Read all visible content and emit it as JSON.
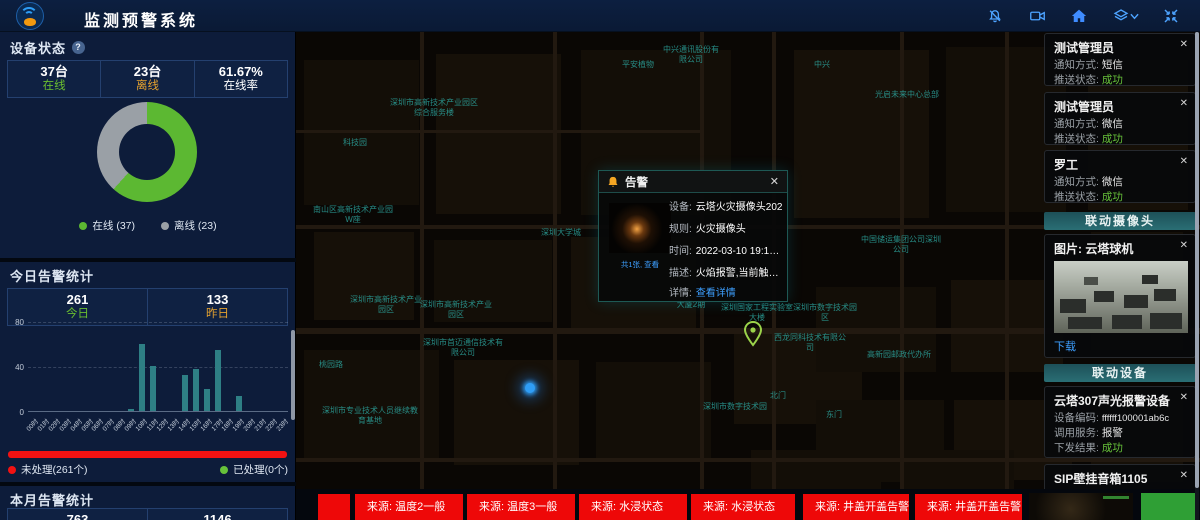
{
  "colors": {
    "green": "#6abe30",
    "orange": "#e3a12f",
    "white": "#ffffff",
    "success": "#67c23a",
    "red": "#f21212",
    "ticker_red": "#ee0808",
    "accent_blue": "#4da3ff",
    "link_blue": "#3d9fff",
    "bar_teal": "#2e7f85",
    "donut_green": "#5cb832",
    "donut_gray": "#9aa0a6"
  },
  "header": {
    "title": "监测预警系统",
    "icons": [
      "notification-bell-icon",
      "video-camera-icon",
      "home-icon",
      "layers-icon",
      "fullscreen-icon"
    ]
  },
  "left_panel": {
    "device_status": {
      "title": "设备状态",
      "help_icon": "?",
      "stats": [
        {
          "value": "37台",
          "label": "在线",
          "color": "#6abe30"
        },
        {
          "value": "23台",
          "label": "离线",
          "color": "#e3a12f"
        },
        {
          "value": "61.67%",
          "label": "在线率",
          "color": "#ffffff"
        }
      ],
      "legend": [
        {
          "label": "在线 (37)",
          "color": "#5cb832"
        },
        {
          "label": "离线 (23)",
          "color": "#9aa0a6"
        }
      ]
    },
    "today_alerts": {
      "title": "今日告警统计",
      "stats": [
        {
          "value": "261",
          "label": "今日",
          "color": "#6abe30"
        },
        {
          "value": "133",
          "label": "昨日",
          "color": "#e3a12f"
        }
      ],
      "unprocessed": {
        "label": "未处理(261个)",
        "color": "#f21212"
      },
      "processed": {
        "label": "已处理(0个)",
        "color": "#67c23a"
      }
    },
    "month_alerts": {
      "title": "本月告警统计",
      "values": [
        "763",
        "1146"
      ]
    }
  },
  "chart_data": [
    {
      "type": "pie",
      "title": "设备状态",
      "labels": [
        "在线",
        "离线"
      ],
      "values": [
        37,
        23
      ],
      "colors": [
        "#5cb832",
        "#9aa0a6"
      ],
      "donut": true,
      "online_rate": "61.67%",
      "legend_position": "bottom"
    },
    {
      "type": "bar",
      "title": "今日告警统计",
      "categories": [
        "00时",
        "01时",
        "02时",
        "03时",
        "04时",
        "05时",
        "06时",
        "07时",
        "08时",
        "09时",
        "10时",
        "11时",
        "12时",
        "13时",
        "14时",
        "15时",
        "16时",
        "17时",
        "18时",
        "19时",
        "20时",
        "21时",
        "22时",
        "23时"
      ],
      "values": [
        0,
        0,
        0,
        0,
        0,
        0,
        0,
        0,
        0,
        2,
        60,
        40,
        0,
        0,
        32,
        37,
        20,
        54,
        0,
        13,
        0,
        0,
        0,
        0
      ],
      "ylim": [
        0,
        80
      ],
      "yticks": [
        0,
        40,
        80
      ],
      "bar_color": "#2e7f85",
      "grid": "dashed"
    }
  ],
  "map": {
    "labels": [
      {
        "text": "中兴通讯股份有限公司",
        "x": 660,
        "y": 45,
        "w": 62
      },
      {
        "text": "平安植物",
        "x": 618,
        "y": 60,
        "w": 40
      },
      {
        "text": "中兴",
        "x": 810,
        "y": 60,
        "w": 24
      },
      {
        "text": "光启未来中心总部",
        "x": 872,
        "y": 90,
        "w": 70
      },
      {
        "text": "深圳市高新技术产业园区综合服务楼",
        "x": 388,
        "y": 98,
        "w": 92
      },
      {
        "text": "科技园",
        "x": 340,
        "y": 138,
        "w": 30
      },
      {
        "text": "南山区高新技术产业园W座",
        "x": 312,
        "y": 205,
        "w": 82
      },
      {
        "text": "深圳大学城",
        "x": 536,
        "y": 228,
        "w": 50
      },
      {
        "text": "便利店",
        "x": 622,
        "y": 230,
        "w": 30
      },
      {
        "text": "中国储运集团公司深圳公司",
        "x": 860,
        "y": 235,
        "w": 82
      },
      {
        "text": "深圳市高新技术产业园区",
        "x": 350,
        "y": 295,
        "w": 72
      },
      {
        "text": "深圳市高新技术产业园区",
        "x": 420,
        "y": 300,
        "w": 72
      },
      {
        "text": "深圳市首迈通信技术有限公司",
        "x": 420,
        "y": 338,
        "w": 86
      },
      {
        "text": "桃园路",
        "x": 316,
        "y": 360,
        "w": 30
      },
      {
        "text": "深圳市专业技术人员继续教育基地",
        "x": 320,
        "y": 406,
        "w": 100
      },
      {
        "text": "大厦2期",
        "x": 674,
        "y": 300,
        "w": 34
      },
      {
        "text": "深圳国家工程实验室大楼",
        "x": 720,
        "y": 303,
        "w": 74
      },
      {
        "text": "深圳市数字技术园区",
        "x": 792,
        "y": 303,
        "w": 66
      },
      {
        "text": "西龙同科技术有限公司",
        "x": 774,
        "y": 333,
        "w": 72
      },
      {
        "text": "高新园邮政代办所",
        "x": 864,
        "y": 350,
        "w": 70
      },
      {
        "text": "深圳市数字技术园",
        "x": 702,
        "y": 402,
        "w": 66
      },
      {
        "text": "北门",
        "x": 768,
        "y": 391,
        "w": 20
      },
      {
        "text": "东门",
        "x": 824,
        "y": 410,
        "w": 20
      }
    ],
    "markers": [
      "device-location-dot",
      "green-location-pin"
    ],
    "popup": {
      "title": "告警",
      "close": "✕",
      "thumb_caption": "共1张, 查看",
      "rows": [
        {
          "label": "设备:",
          "value": "云塔火灾摄像头202"
        },
        {
          "label": "规则:",
          "value": "火灾摄像头"
        },
        {
          "label": "时间:",
          "value": "2022-03-10 19:13:07"
        },
        {
          "label": "描述:",
          "value": "火焰报警,当前触发值为..."
        },
        {
          "label": "详情:",
          "value": "查看详情"
        }
      ]
    }
  },
  "right_panel": {
    "notifications": [
      {
        "title": "测试管理员",
        "close": "✕",
        "rows": [
          {
            "label": "通知方式: ",
            "value": "短信"
          },
          {
            "label": "推送状态: ",
            "value": "成功",
            "success": true
          }
        ]
      },
      {
        "title": "测试管理员",
        "close": "✕",
        "rows": [
          {
            "label": "通知方式: ",
            "value": "微信"
          },
          {
            "label": "推送状态: ",
            "value": "成功",
            "success": true
          }
        ]
      },
      {
        "title": "罗工",
        "close": "✕",
        "rows": [
          {
            "label": "通知方式: ",
            "value": "微信"
          },
          {
            "label": "推送状态: ",
            "value": "成功",
            "success": true
          }
        ]
      }
    ],
    "camera_section": {
      "title": "联动摄像头",
      "caption": "图片: 云塔球机",
      "close": "✕",
      "download_label": "下载"
    },
    "device_section": {
      "title": "联动设备",
      "cards": [
        {
          "title": "云塔307声光报警设备",
          "close": "✕",
          "rows": [
            {
              "label": "设备编码: ",
              "value": "ffffff100001ab6c"
            },
            {
              "label": "调用服务: ",
              "value": "报警"
            },
            {
              "label": "下发结果: ",
              "value": "成功",
              "success": true
            }
          ]
        },
        {
          "title": "SIP壁挂音箱1105",
          "close": "✕",
          "rows": [
            {
              "label": "设备编码: ",
              "value": "1106"
            }
          ]
        }
      ]
    }
  },
  "ticker": {
    "items": [
      "",
      "来源: 温度2一般",
      "来源: 温度3一般",
      "来源: 水浸状态",
      "来源: 水浸状态",
      "来源: 井盖开盖告警",
      "来源: 井盖开盖告警"
    ],
    "previews": [
      "camera-frame-preview",
      "green-frame-preview"
    ]
  }
}
